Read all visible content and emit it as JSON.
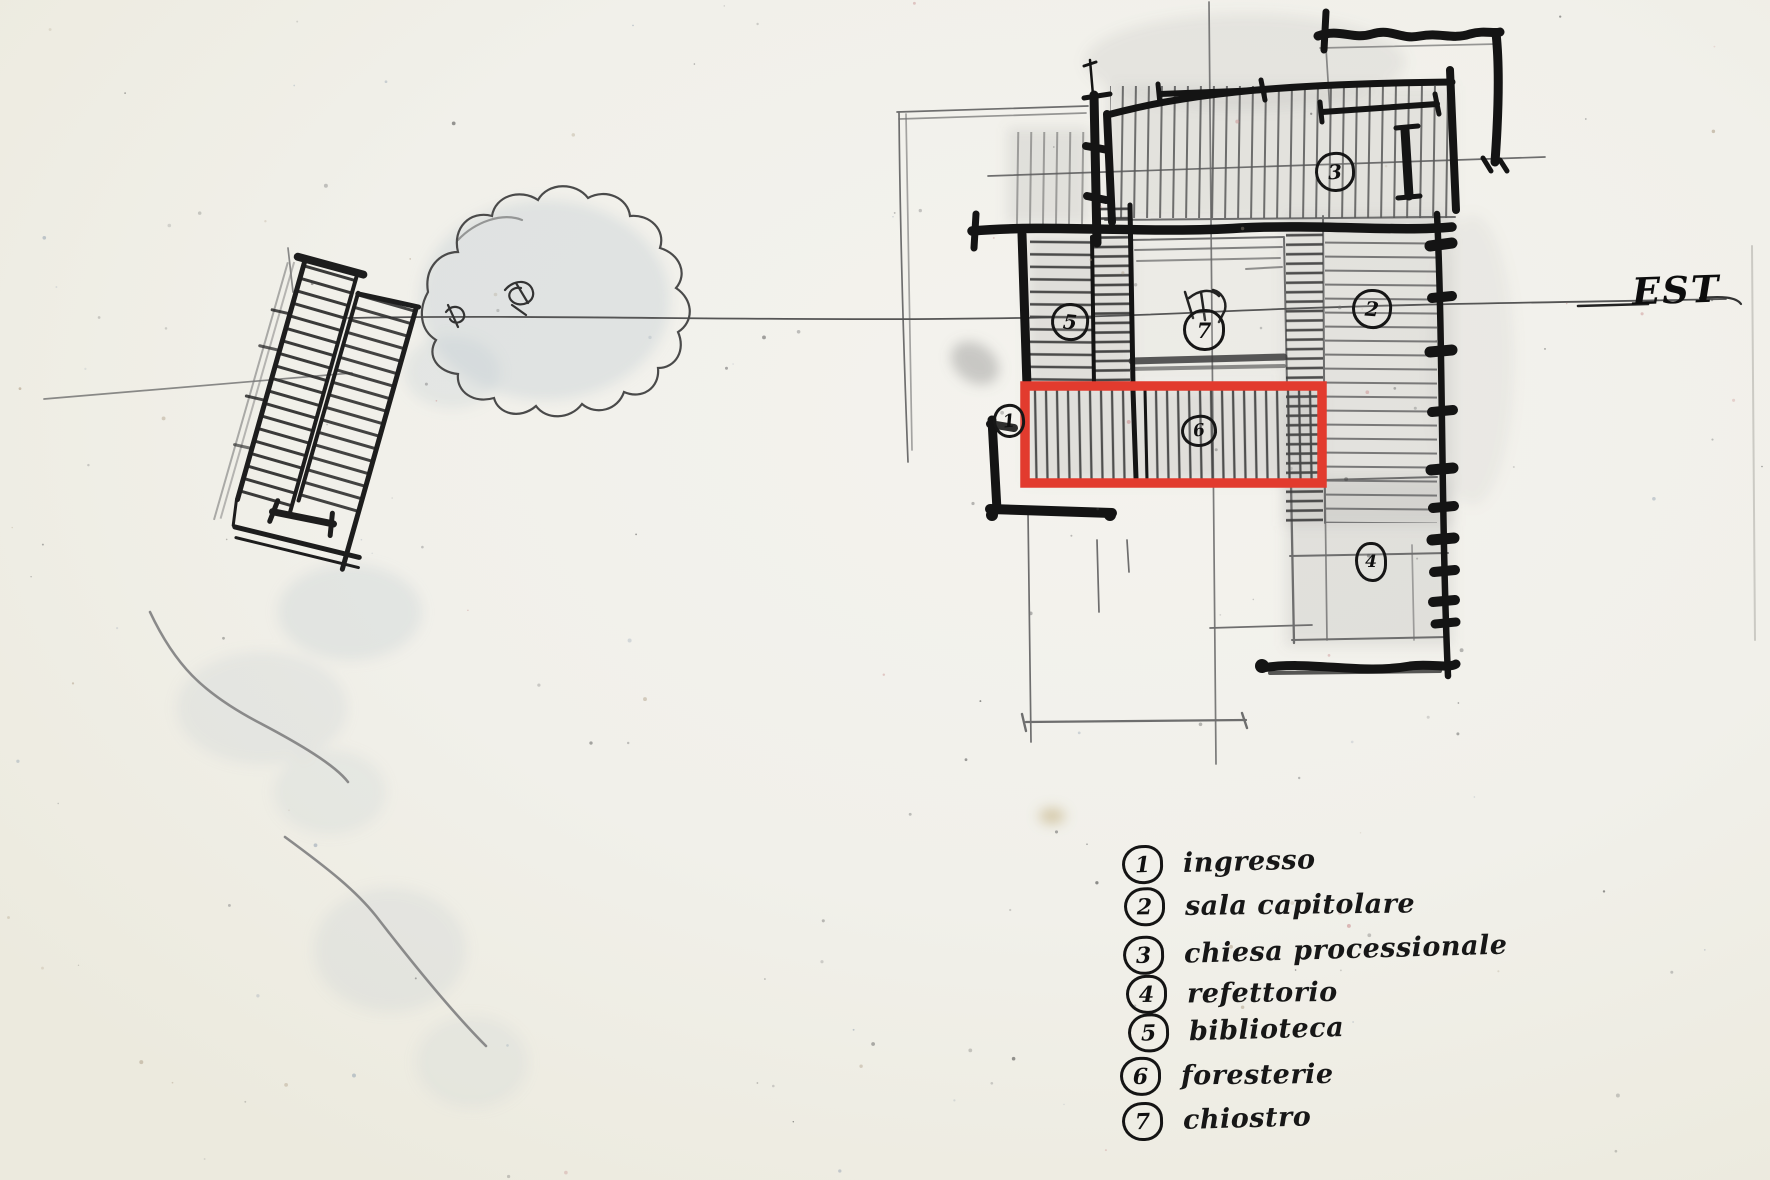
{
  "drawing": {
    "description": "hand-drawn monastery plan sketch in pencil",
    "pencil_color": "#2f2f2f",
    "paper_color": "#f2f1ec"
  },
  "compass": {
    "east_label": "EST"
  },
  "annotation": {
    "highlight_color": "#e23b2e",
    "highlighted_room_number": "6",
    "highlighted_room_label": "foresterie"
  },
  "plan": {
    "markers": [
      {
        "number": "1",
        "room": "ingresso"
      },
      {
        "number": "2",
        "room": "sala capitolare"
      },
      {
        "number": "3",
        "room": "chiesa processionale"
      },
      {
        "number": "4",
        "room": "refettorio"
      },
      {
        "number": "5",
        "room": "biblioteca"
      },
      {
        "number": "6",
        "room": "foresterie"
      },
      {
        "number": "7",
        "room": "chiostro"
      }
    ]
  },
  "legend": {
    "items": [
      {
        "number": "1",
        "label": "ingresso"
      },
      {
        "number": "2",
        "label": "sala capitolare"
      },
      {
        "number": "3",
        "label": "chiesa processionale"
      },
      {
        "number": "4",
        "label": "refettorio"
      },
      {
        "number": "5",
        "label": "biblioteca"
      },
      {
        "number": "6",
        "label": "foresterie"
      },
      {
        "number": "7",
        "label": "chiostro"
      }
    ]
  }
}
